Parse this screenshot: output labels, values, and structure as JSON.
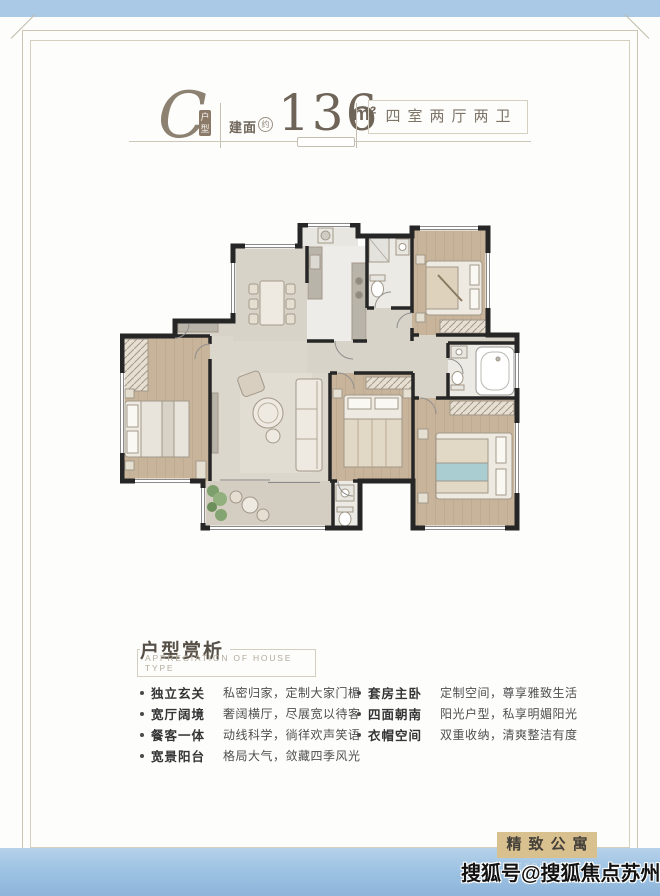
{
  "header": {
    "unit_letter": "C",
    "unit_badge": "户型",
    "area_label": "建面",
    "area_approx": "约",
    "area_value": "136",
    "area_unit": "m²",
    "rooms_label": "四室两厅两卫"
  },
  "analysis": {
    "title": "户型赏析",
    "subtitle": "APPRECIATION OF HOUSE TYPE",
    "left_items": [
      {
        "label": "独立玄关",
        "desc": "私密归家，定制大家门楣"
      },
      {
        "label": "宽厅阔境",
        "desc": "奢阔横厅，尽展宽以待客"
      },
      {
        "label": "餐客一体",
        "desc": "动线科学，徜徉欢声笑语"
      },
      {
        "label": "宽景阳台",
        "desc": "格局大气，敛藏四季风光"
      }
    ],
    "right_items": [
      {
        "label": "套房主卧",
        "desc": "定制空间，尊享雅致生活"
      },
      {
        "label": "四面朝南",
        "desc": "阳光户型，私享明媚阳光"
      },
      {
        "label": "衣帽空间",
        "desc": "双重收纳，清爽整洁有度"
      }
    ]
  },
  "footer": {
    "brand": "精致公寓",
    "brand_en": "EXQUISITE RESIDENCE",
    "watermark": "搜狐号@搜狐焦点苏州站"
  },
  "colors": {
    "band_blue": "#a9c9e7",
    "frame_line": "#ccc5b4",
    "title_brown": "#8d8172",
    "brand_bg": "#d9c08f",
    "wall_black": "#262626",
    "wood_floor": "#c8b49a",
    "tile_floor": "#d8d3c9"
  }
}
